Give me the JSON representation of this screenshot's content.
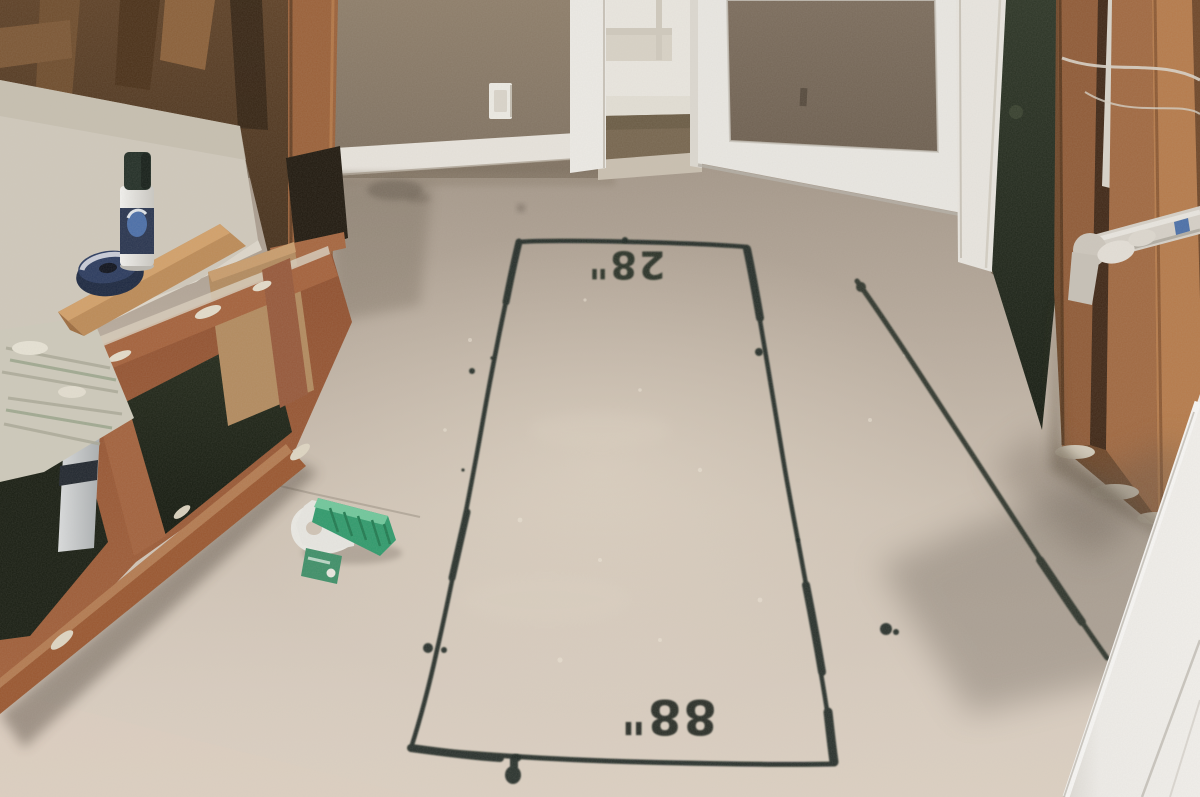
{
  "scene": {
    "description": "Gutted room during renovation: demolished vanity cabinet at left, dusty subfloor with black spray-painted layout rectangle, open doorways at rear, exposed studs and plumbing at right, open white door in right foreground."
  },
  "markings": {
    "width_label": "28\"",
    "length_label": "88\"",
    "paint_color": "#1f2720"
  },
  "objects": {
    "spray_can": "spray paint can",
    "tape_roll": "painters tape roll",
    "scrub_brush": "green scrub brush",
    "light_switch": "light switch",
    "pvc_pipes": "PVC drain pipes",
    "wood_plank": "wood plank",
    "carpet_room": "carpeted room beyond doorway"
  },
  "colors": {
    "floor_light": "#d8ccbf",
    "floor_dark": "#9e9183",
    "wall_taupe": "#8a7a66",
    "demo_wall": "#573d26",
    "stud_wood": "#a86f44",
    "cabinet_wood": "#9a5a36",
    "carpet": "#76654e",
    "trim_white": "#e9e6df",
    "brush_green": "#2f9a6c",
    "tape_blue": "#1d2b47",
    "spray_paint": "#1f2720"
  }
}
